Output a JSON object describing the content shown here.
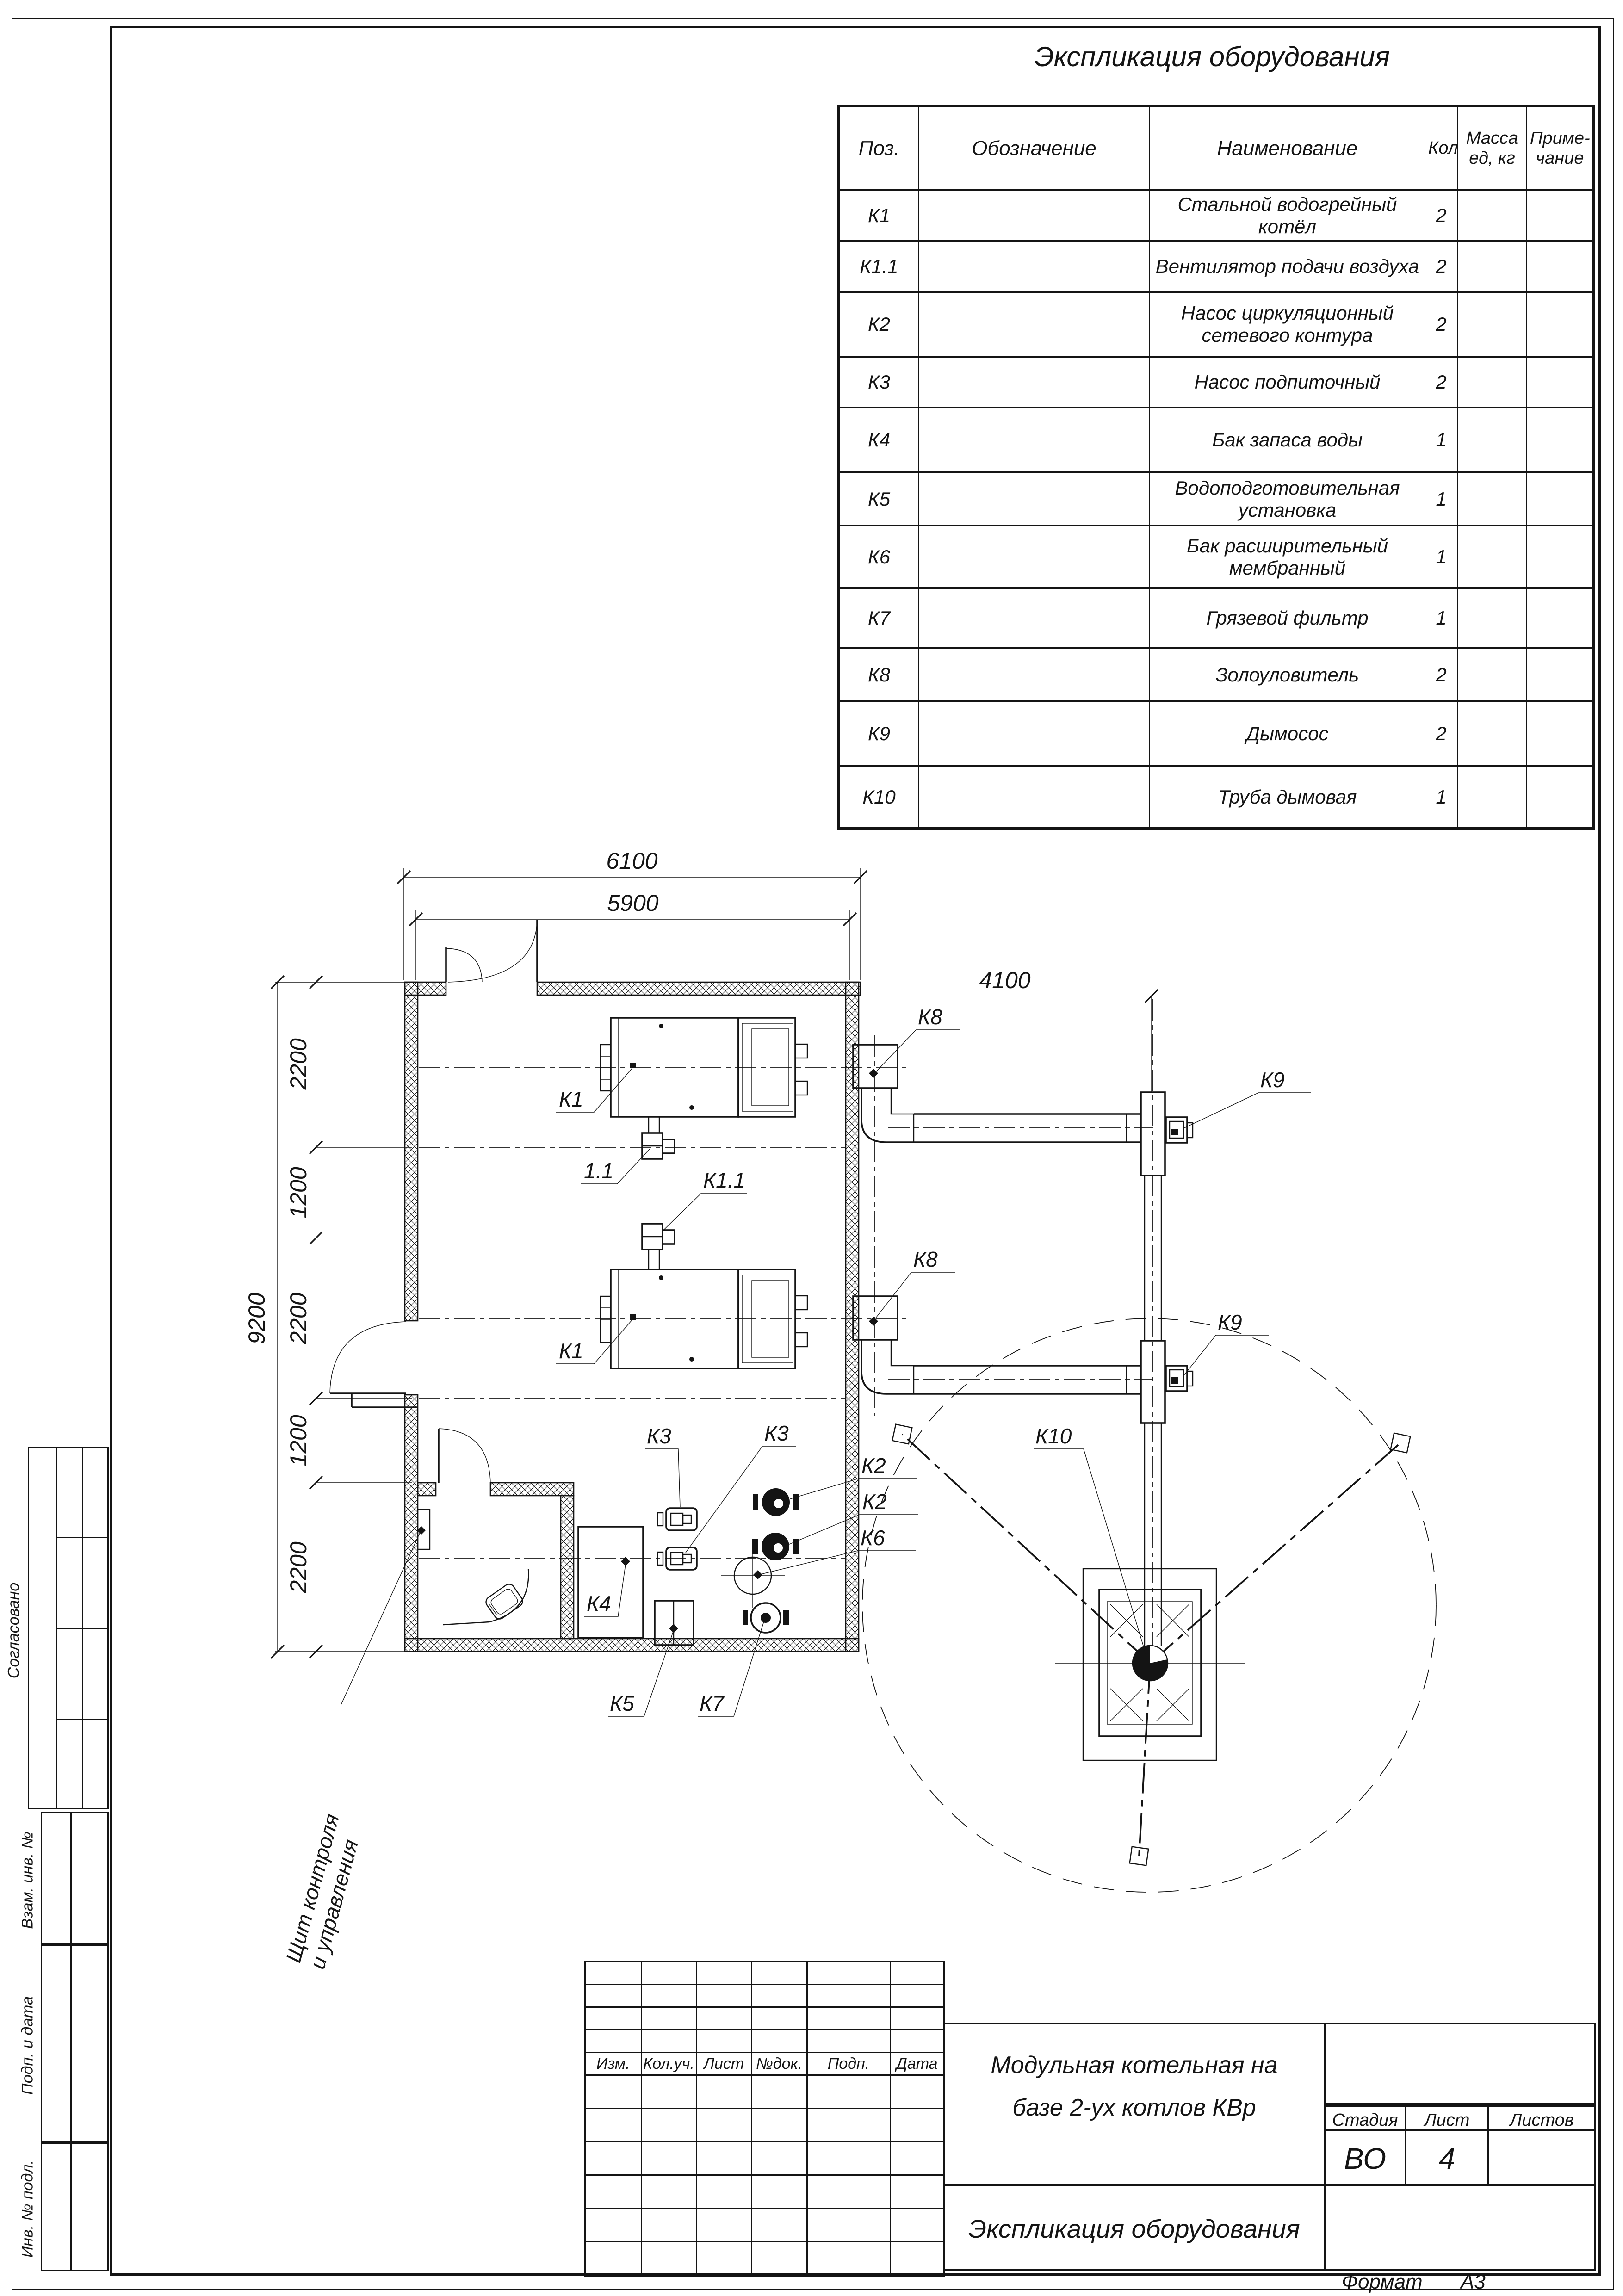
{
  "page": {
    "format_label": "Формат",
    "format_value": "А3"
  },
  "spec_table": {
    "title": "Экспликация оборудования",
    "columns": {
      "pos": "Поз.",
      "designation": "Обозначение",
      "name": "Наименование",
      "qty": "Кол.",
      "mass_line1": "Масса",
      "mass_line2": "ед, кг",
      "note_line1": "Приме-",
      "note_line2": "чание"
    },
    "rows": [
      {
        "pos": "К1",
        "designation": "",
        "name": "Стальной водогрейный котёл",
        "qty": "2",
        "mass": "",
        "note": ""
      },
      {
        "pos": "К1.1",
        "designation": "",
        "name": "Вентилятор подачи воздуха",
        "qty": "2",
        "mass": "",
        "note": ""
      },
      {
        "pos": "К2",
        "designation": "",
        "name": "Насос циркуляционный сетевого контура",
        "qty": "2",
        "mass": "",
        "note": ""
      },
      {
        "pos": "К3",
        "designation": "",
        "name": "Насос подпиточный",
        "qty": "2",
        "mass": "",
        "note": ""
      },
      {
        "pos": "К4",
        "designation": "",
        "name": "Бак запаса воды",
        "qty": "1",
        "mass": "",
        "note": ""
      },
      {
        "pos": "К5",
        "designation": "",
        "name": "Водоподготовительная установка",
        "qty": "1",
        "mass": "",
        "note": ""
      },
      {
        "pos": "К6",
        "designation": "",
        "name": "Бак расширительный мембранный",
        "qty": "1",
        "mass": "",
        "note": ""
      },
      {
        "pos": "К7",
        "designation": "",
        "name": "Грязевой фильтр",
        "qty": "1",
        "mass": "",
        "note": ""
      },
      {
        "pos": "К8",
        "designation": "",
        "name": "Золоуловитель",
        "qty": "2",
        "mass": "",
        "note": ""
      },
      {
        "pos": "К9",
        "designation": "",
        "name": "Дымосос",
        "qty": "2",
        "mass": "",
        "note": ""
      },
      {
        "pos": "К10",
        "designation": "",
        "name": "Труба дымовая",
        "qty": "1",
        "mass": "",
        "note": ""
      }
    ]
  },
  "title_block": {
    "rev_headers": [
      "Изм.",
      "Кол.уч.",
      "Лист",
      "№док.",
      "Подп.",
      "Дата"
    ],
    "project_line1": "Модульная котельная на",
    "project_line2": "базе 2-ух котлов КВр",
    "stage_label": "Стадия",
    "sheet_label": "Лист",
    "sheets_label": "Листов",
    "stage_value": "ВО",
    "sheet_value": "4",
    "sheets_value": "",
    "doc_title": "Экспликация оборудования"
  },
  "side_stamp": {
    "approved": "Согласовано",
    "rows": [
      "Взам. инв. №",
      "Подп. и дата",
      "Инв. № подл."
    ]
  },
  "plan": {
    "dims": {
      "total_width": "6100",
      "inner_width": "5900",
      "flue_offset": "4100",
      "total_height": "9200",
      "chain": [
        "2200",
        "1200",
        "2200",
        "1200",
        "2200"
      ]
    },
    "labels": {
      "k1": "К1",
      "k11": "К1.1",
      "v11": "1.1",
      "k2": "К2",
      "k3": "К3",
      "k4": "К4",
      "k5": "К5",
      "k6": "К6",
      "k7": "К7",
      "k8": "К8",
      "k9": "К9",
      "k10": "К10"
    },
    "panel_line1": "Щит контроля",
    "panel_line2": "и управления"
  }
}
